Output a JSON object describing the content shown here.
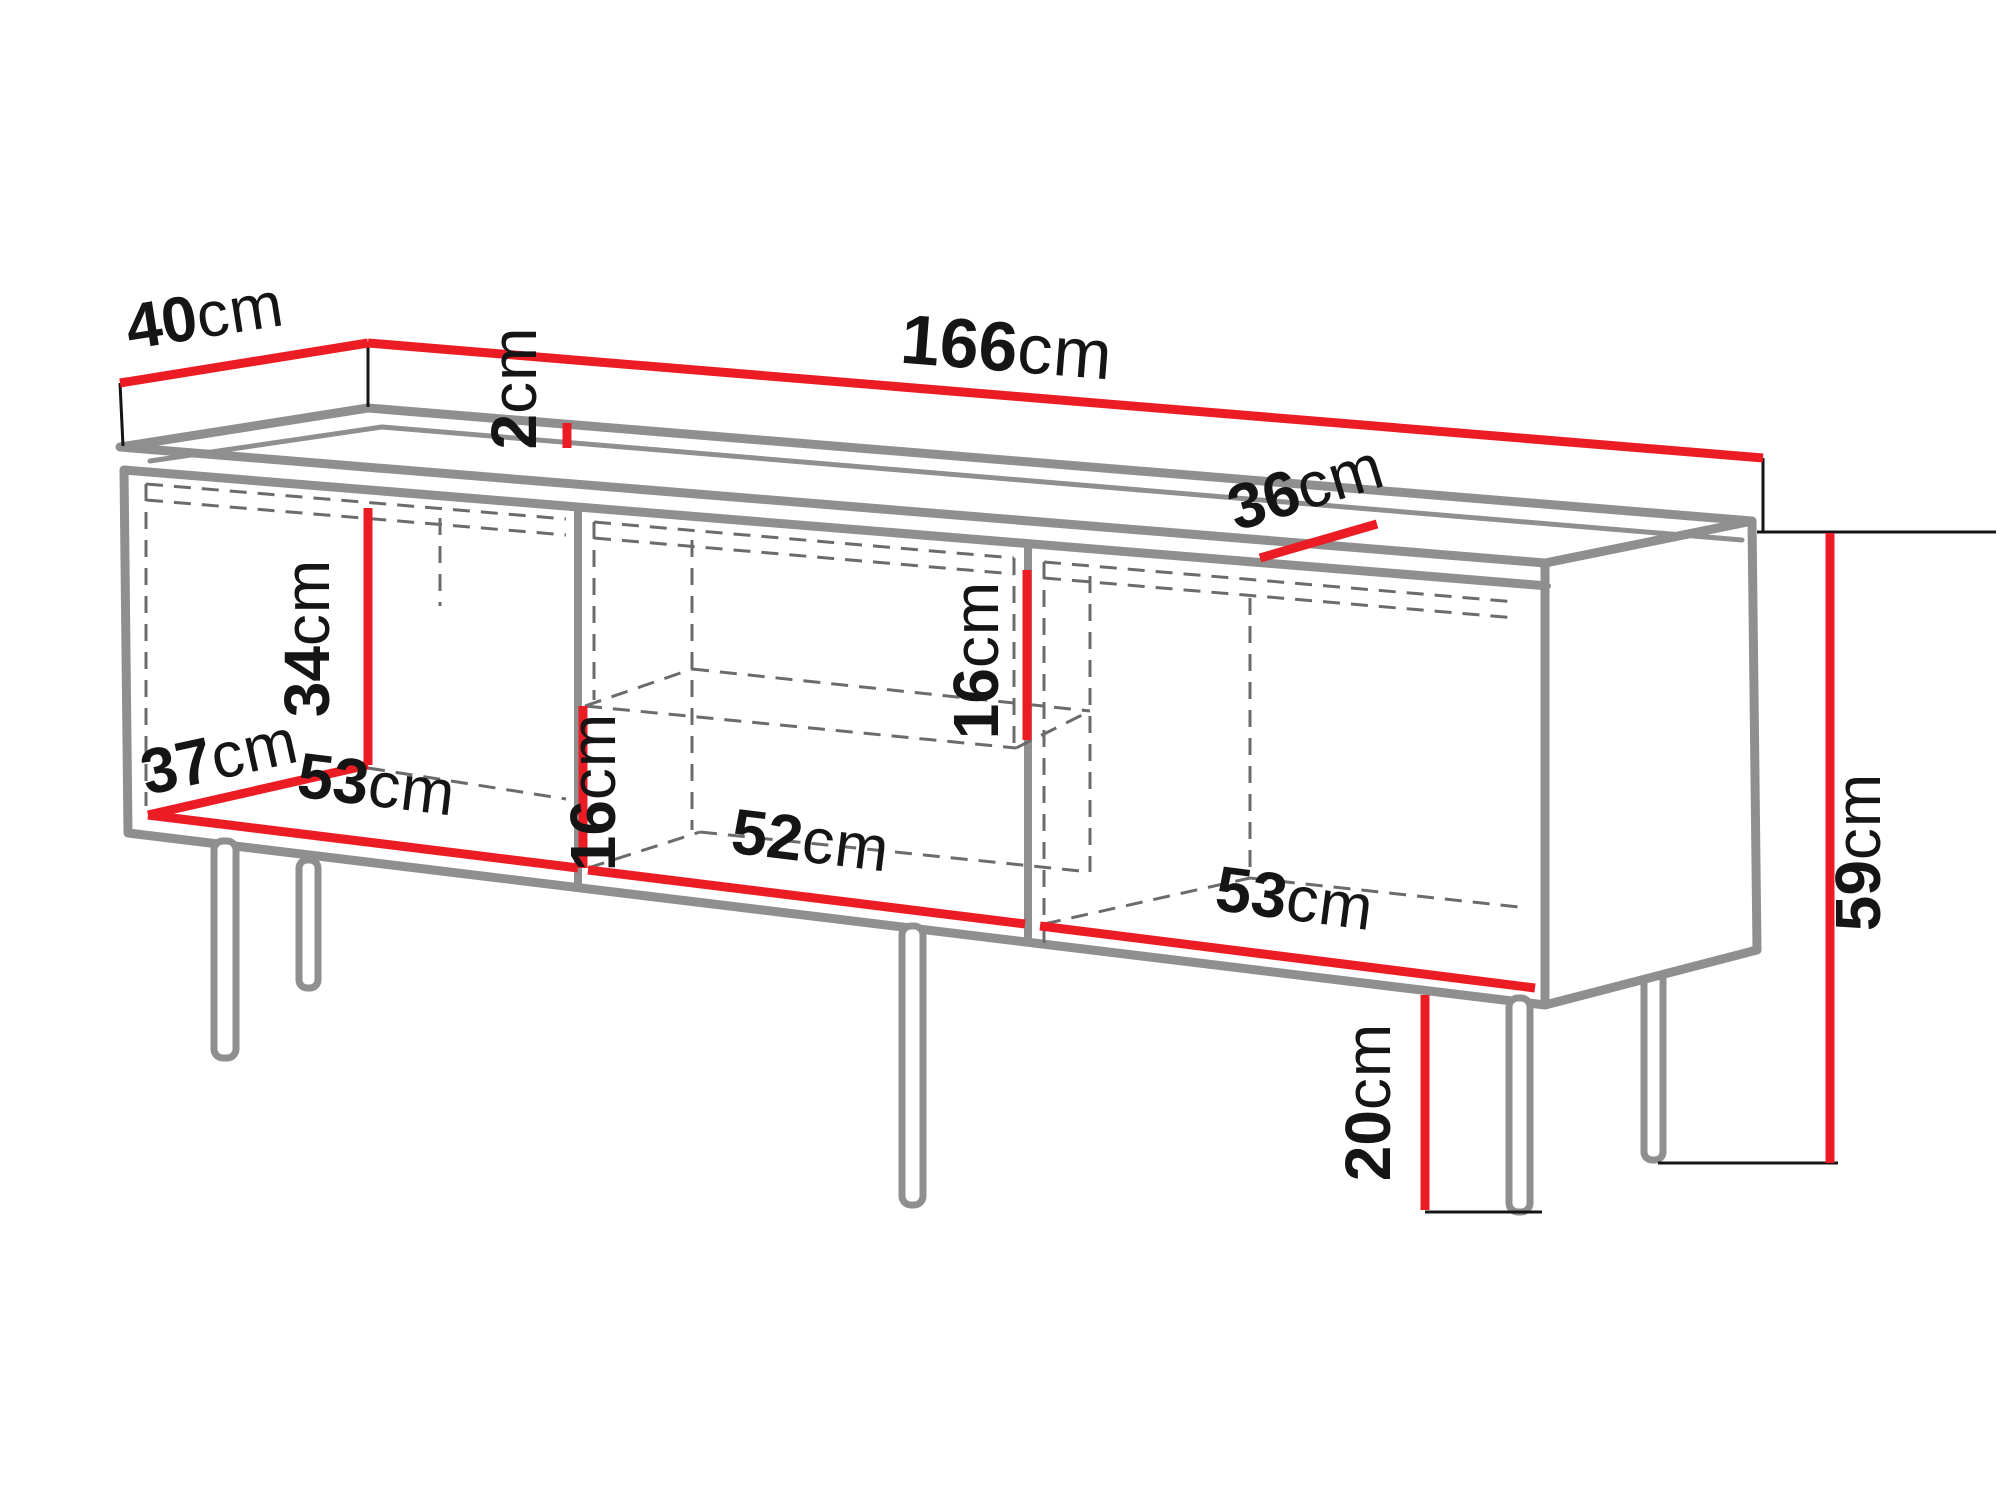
{
  "meta": {
    "figure_type": "furniture dimension diagram",
    "subject": "three-section TV stand / sideboard on metal legs",
    "unit": "cm",
    "background": "#ffffff"
  },
  "colors": {
    "dimension_accent": "#ec1c24",
    "structure_gray": "#8f8f8f",
    "dashed_gray": "#6b6b6b",
    "text_black": "#151515"
  },
  "dimensions": [
    {
      "id": "top-depth",
      "value": "40",
      "unit": "cm"
    },
    {
      "id": "total-width",
      "value": "166",
      "unit": "cm"
    },
    {
      "id": "top-thickness",
      "value": "2",
      "unit": "cm"
    },
    {
      "id": "interior-depth-right",
      "value": "36",
      "unit": "cm"
    },
    {
      "id": "interior-height-left",
      "value": "34",
      "unit": "cm"
    },
    {
      "id": "interior-depth-left",
      "value": "37",
      "unit": "cm"
    },
    {
      "id": "interior-width-left",
      "value": "53",
      "unit": "cm"
    },
    {
      "id": "compartment-height-lower",
      "value": "16",
      "unit": "cm"
    },
    {
      "id": "interior-width-middle",
      "value": "52",
      "unit": "cm"
    },
    {
      "id": "compartment-height-upper",
      "value": "16",
      "unit": "cm"
    },
    {
      "id": "interior-width-right",
      "value": "53",
      "unit": "cm"
    },
    {
      "id": "total-height",
      "value": "59",
      "unit": "cm"
    },
    {
      "id": "leg-height",
      "value": "20",
      "unit": "cm"
    }
  ]
}
